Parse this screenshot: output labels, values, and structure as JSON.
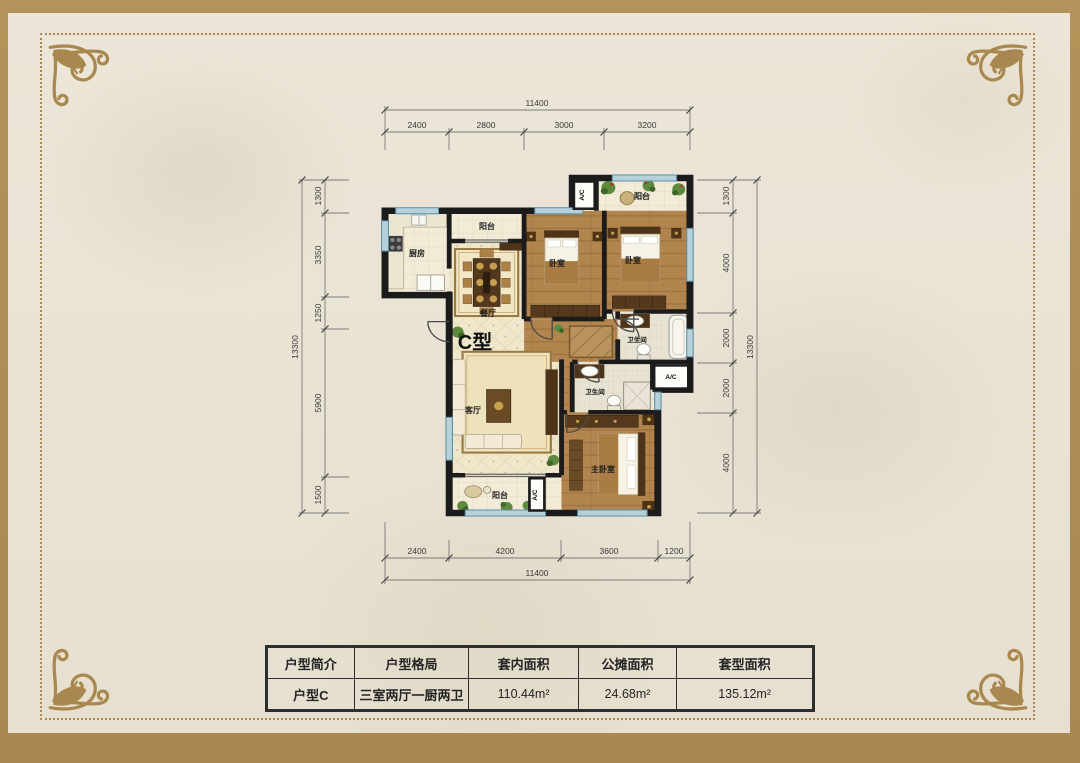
{
  "page": {
    "frame_color": "#ad8c54",
    "paper_color": "#ebe5d6",
    "wall_color": "#1b1b1b",
    "wood_color": "#b3854e",
    "window_color": "#b5d2dc",
    "accent_gold": "#a8884e"
  },
  "plan": {
    "unit_label": "C型",
    "ac_label": "A/C",
    "rooms": {
      "kitchen": "厨房",
      "balcony_top": "阳台",
      "balcony_right": "阳台",
      "balcony_bottom": "阳台",
      "bedroom1": "卧室",
      "bedroom2": "卧室",
      "master_bedroom": "主卧室",
      "dining": "餐厅",
      "living": "客厅",
      "bath1": "卫生间",
      "bath2": "卫生间"
    },
    "dims": {
      "top": {
        "total": "11400",
        "segments": [
          "2400",
          "2800",
          "3000",
          "3200"
        ]
      },
      "bottom": {
        "total": "11400",
        "segments": [
          "2400",
          "4200",
          "3600",
          "1200"
        ]
      },
      "left": {
        "total": "13300",
        "segments": [
          "1300",
          "3350",
          "1250",
          "5900",
          "1500"
        ]
      },
      "right": {
        "total": "13300",
        "segments": [
          "1300",
          "4000",
          "2000",
          "2000",
          "4000"
        ]
      }
    }
  },
  "table": {
    "headers": [
      "户型简介",
      "户型格局",
      "套内面积",
      "公摊面积",
      "套型面积"
    ],
    "row": [
      "户型C",
      "三室两厅一厨两卫",
      "110.44m²",
      "24.68m²",
      "135.12m²"
    ]
  }
}
